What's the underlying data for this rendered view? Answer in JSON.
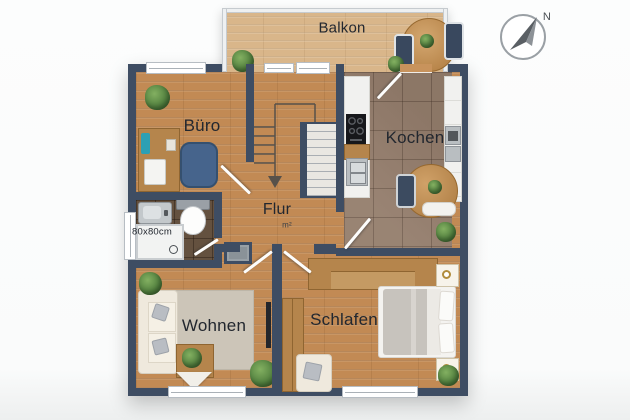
{
  "compass": {
    "north_label": "N"
  },
  "rooms": {
    "balkon": {
      "label": "Balkon"
    },
    "buero": {
      "label": "Büro"
    },
    "kochen": {
      "label": "Kochen"
    },
    "flur": {
      "label": "Flur",
      "area_note": "m²"
    },
    "wohnen": {
      "label": "Wohnen"
    },
    "schlafen": {
      "label": "Schlafen"
    },
    "bad": {
      "shower_size": "80x80cm"
    }
  },
  "colors": {
    "wall": "#3e4d63",
    "wood_floor": "#c28a54",
    "balcony_wood": "#d9b68a",
    "kitchen_tile": "#947d6c",
    "bathroom_tile": "#64513f",
    "plant_green": "#4e7c3c"
  }
}
